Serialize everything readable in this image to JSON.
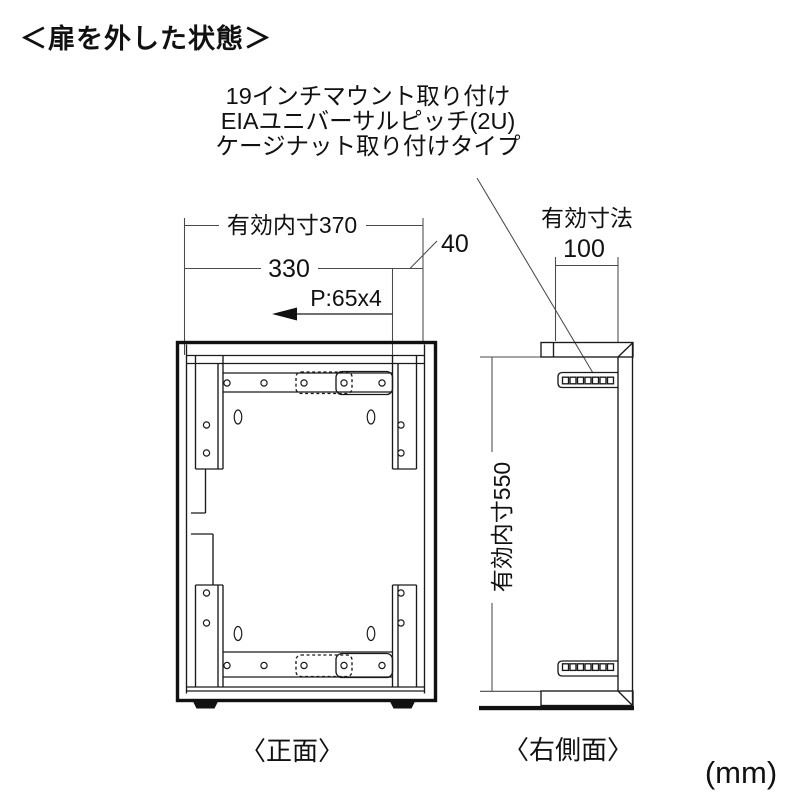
{
  "title": "＜扉を外した状態＞",
  "annotation": {
    "line1": "19インチマウント取り付け",
    "line2": "EIAユニバーサルピッチ(2U)",
    "line3": "ケージナット取り付けタイプ"
  },
  "front_view": {
    "caption": "〈正面〉",
    "dim_inner_width": "有効内寸370",
    "dim_rail_width": "330",
    "dim_offset": "40",
    "dim_pitch": "P:65x4"
  },
  "side_view": {
    "caption": "〈右側面〉",
    "dim_depth_label": "有効寸法",
    "dim_depth_value": "100",
    "dim_inner_height": "有効内寸550"
  },
  "unit": "(mm)",
  "colors": {
    "line": "#1a1a1a",
    "dim_line": "#4a4a4a",
    "background": "#ffffff"
  }
}
